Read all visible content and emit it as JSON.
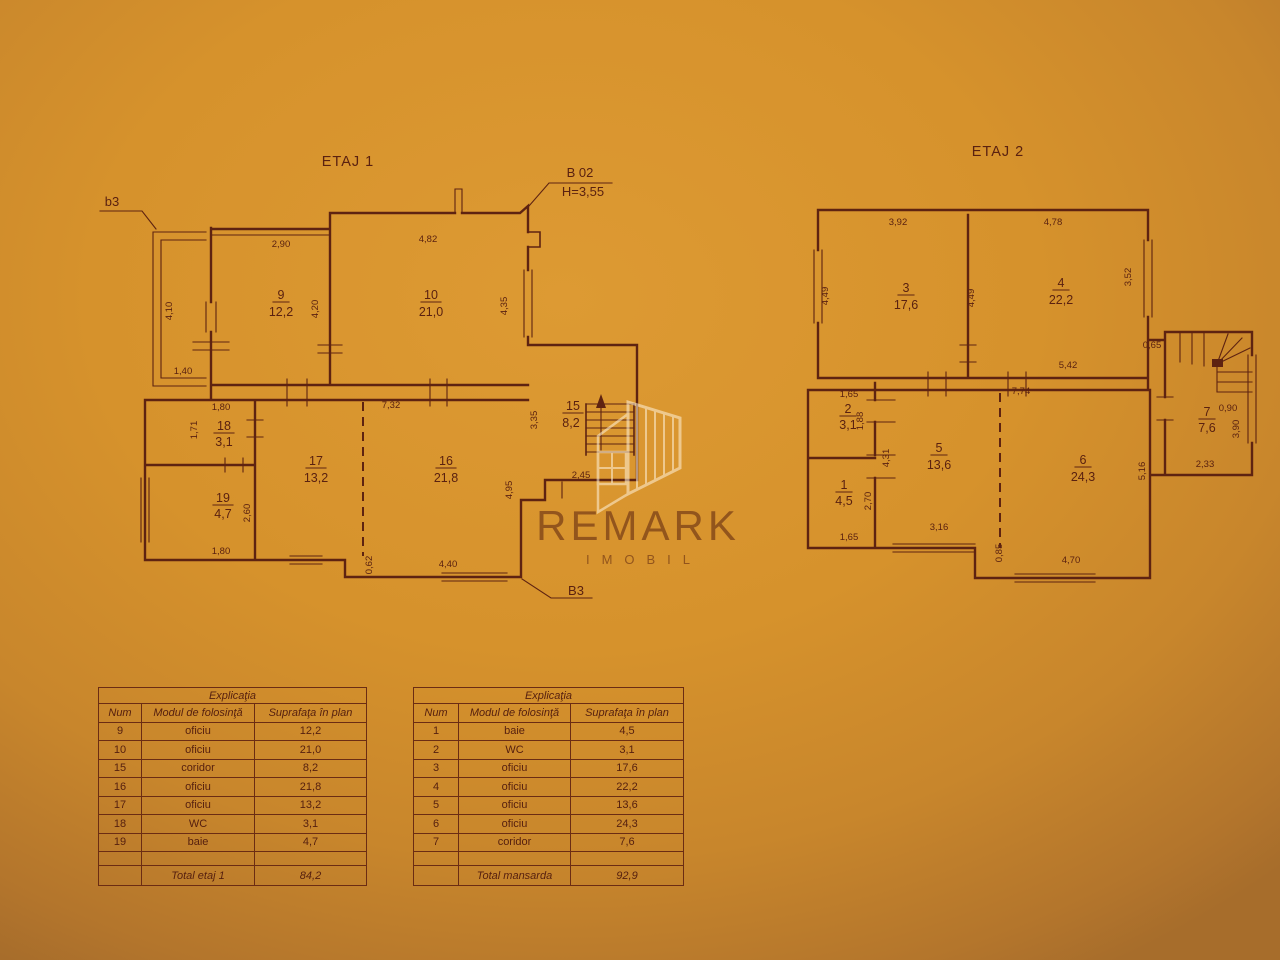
{
  "plan1": {
    "title": "ETAJ 1",
    "labels": {
      "balcony": "b3",
      "section_top": "B 02",
      "height": "H=3,55",
      "section_bottom": "B3"
    },
    "rooms": [
      {
        "num": "9",
        "area": "12,2"
      },
      {
        "num": "10",
        "area": "21,0"
      },
      {
        "num": "15",
        "area": "8,2"
      },
      {
        "num": "16",
        "area": "21,8"
      },
      {
        "num": "17",
        "area": "13,2"
      },
      {
        "num": "18",
        "area": "3,1"
      },
      {
        "num": "19",
        "area": "4,7"
      }
    ],
    "dims": [
      "2,90",
      "4,82",
      "4,10",
      "4,20",
      "4,35",
      "1,40",
      "1,80",
      "1,71",
      "7,32",
      "3,35",
      "2,45",
      "2,60",
      "1,80",
      "0,62",
      "4,40",
      "4,95"
    ]
  },
  "plan2": {
    "title": "ETAJ 2",
    "rooms": [
      {
        "num": "3",
        "area": "17,6"
      },
      {
        "num": "4",
        "area": "22,2"
      },
      {
        "num": "2",
        "area": "3,1"
      },
      {
        "num": "1",
        "area": "4,5"
      },
      {
        "num": "5",
        "area": "13,6"
      },
      {
        "num": "6",
        "area": "24,3"
      },
      {
        "num": "7",
        "area": "7,6"
      }
    ],
    "dims": [
      "3,92",
      "4,78",
      "4,49",
      "4,49",
      "3,52",
      "0,65",
      "5,42",
      "7,74",
      "1,65",
      "1,88",
      "4,31",
      "2,70",
      "1,65",
      "3,16",
      "0,85",
      "4,70",
      "5,16",
      "2,33",
      "0,90",
      "3,90"
    ]
  },
  "tables": [
    {
      "title": "Explicaţia",
      "headers": [
        "Num",
        "Modul de folosinţă",
        "Suprafaţa în plan"
      ],
      "rows": [
        [
          "9",
          "oficiu",
          "12,2"
        ],
        [
          "10",
          "oficiu",
          "21,0"
        ],
        [
          "15",
          "coridor",
          "8,2"
        ],
        [
          "16",
          "oficiu",
          "21,8"
        ],
        [
          "17",
          "oficiu",
          "13,2"
        ],
        [
          "18",
          "WC",
          "3,1"
        ],
        [
          "19",
          "baie",
          "4,7"
        ]
      ],
      "total_label": "Total etaj 1",
      "total_value": "84,2"
    },
    {
      "title": "Explicaţia",
      "headers": [
        "Num",
        "Modul de folosinţă",
        "Suprafaţa în plan"
      ],
      "rows": [
        [
          "1",
          "baie",
          "4,5"
        ],
        [
          "2",
          "WC",
          "3,1"
        ],
        [
          "3",
          "oficiu",
          "17,6"
        ],
        [
          "4",
          "oficiu",
          "22,2"
        ],
        [
          "5",
          "oficiu",
          "13,6"
        ],
        [
          "6",
          "oficiu",
          "24,3"
        ],
        [
          "7",
          "coridor",
          "7,6"
        ]
      ],
      "total_label": "Total mansarda",
      "total_value": "92,9"
    }
  ],
  "watermark": {
    "title": "REMARK",
    "subtitle": "IMOBIL"
  },
  "colors": {
    "paper": "#d4902a",
    "ink": "#5e2311",
    "watermark": "#fff3db"
  }
}
